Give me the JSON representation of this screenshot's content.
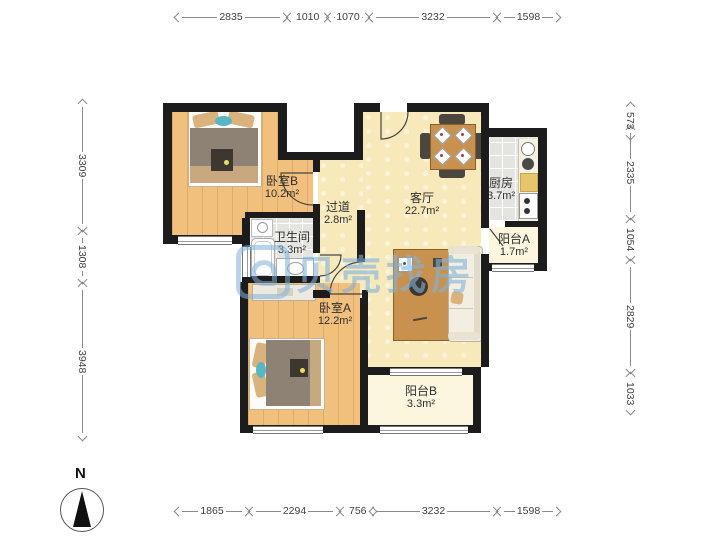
{
  "rooms": [
    {
      "name": "卧室B",
      "area": "10.2m²"
    },
    {
      "name": "过道",
      "area": "2.8m²"
    },
    {
      "name": "客厅",
      "area": "22.7m²"
    },
    {
      "name": "厨房",
      "area": "3.7m²"
    },
    {
      "name": "阳台A",
      "area": "1.7m²"
    },
    {
      "name": "卫生间",
      "area": "3.3m²"
    },
    {
      "name": "卧室A",
      "area": "12.2m²"
    },
    {
      "name": "阳台B",
      "area": "3.3m²"
    }
  ],
  "dims": {
    "top": [
      "2835",
      "1010",
      "1070",
      "3232",
      "1598"
    ],
    "bottom": [
      "1865",
      "2294",
      "756",
      "3232",
      "1598"
    ],
    "left": [
      "3309",
      "1308",
      "3948"
    ],
    "right": [
      "573",
      "2335",
      "1054",
      "2829",
      "1033"
    ]
  },
  "compass": {
    "label": "N"
  },
  "watermark": {
    "text": "贝壳找房"
  },
  "colors": {
    "wall": "#1c1c1c",
    "wood": "#f1c07c",
    "beige": "#f8e9bb",
    "tile": "#e4e4e1",
    "cream": "#fcf6df",
    "watermark_blue": "#7eb2dc"
  }
}
